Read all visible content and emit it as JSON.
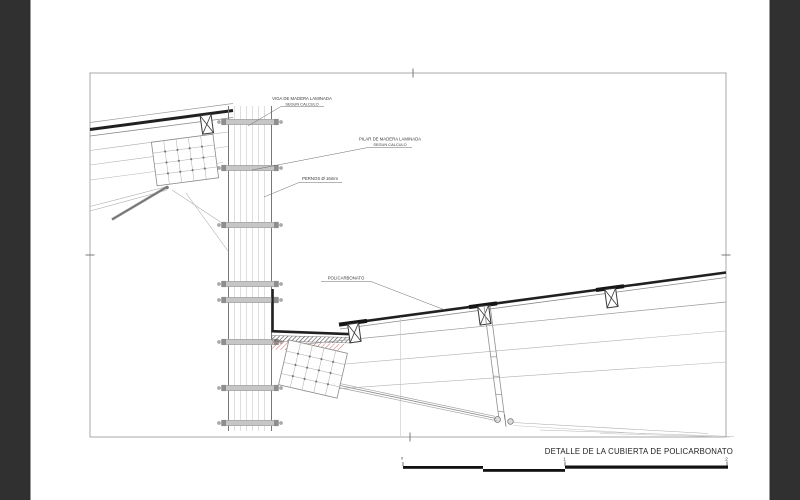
{
  "viewer": {
    "background_color": "#303030",
    "paper_color": "#ffffff"
  },
  "drawing": {
    "title": "DETALLE DE LA CUBIERTA DE POLICARBONATO",
    "annotations": [
      {
        "line1": "VIGA DE MADERA LAMINADA",
        "line2": "SEGUN CALCULO"
      },
      {
        "line1": "PILAR DE MADERA LAMINADA",
        "line2": "SEGUN CALCULO"
      },
      {
        "line1": "PERNOS Ø 16mm"
      },
      {
        "line1": "POLICARBONATO"
      }
    ],
    "scale_bar": {
      "labels": [
        "0",
        "1",
        "2"
      ]
    },
    "colors": {
      "heavy_line": "#202020",
      "medium_line": "#6a6a6a",
      "light_line": "#b5b5b5",
      "hatch_red": "#c25b5b",
      "frame_line": "#a8a8a8",
      "connector_fill": "#c6c6c6"
    }
  }
}
